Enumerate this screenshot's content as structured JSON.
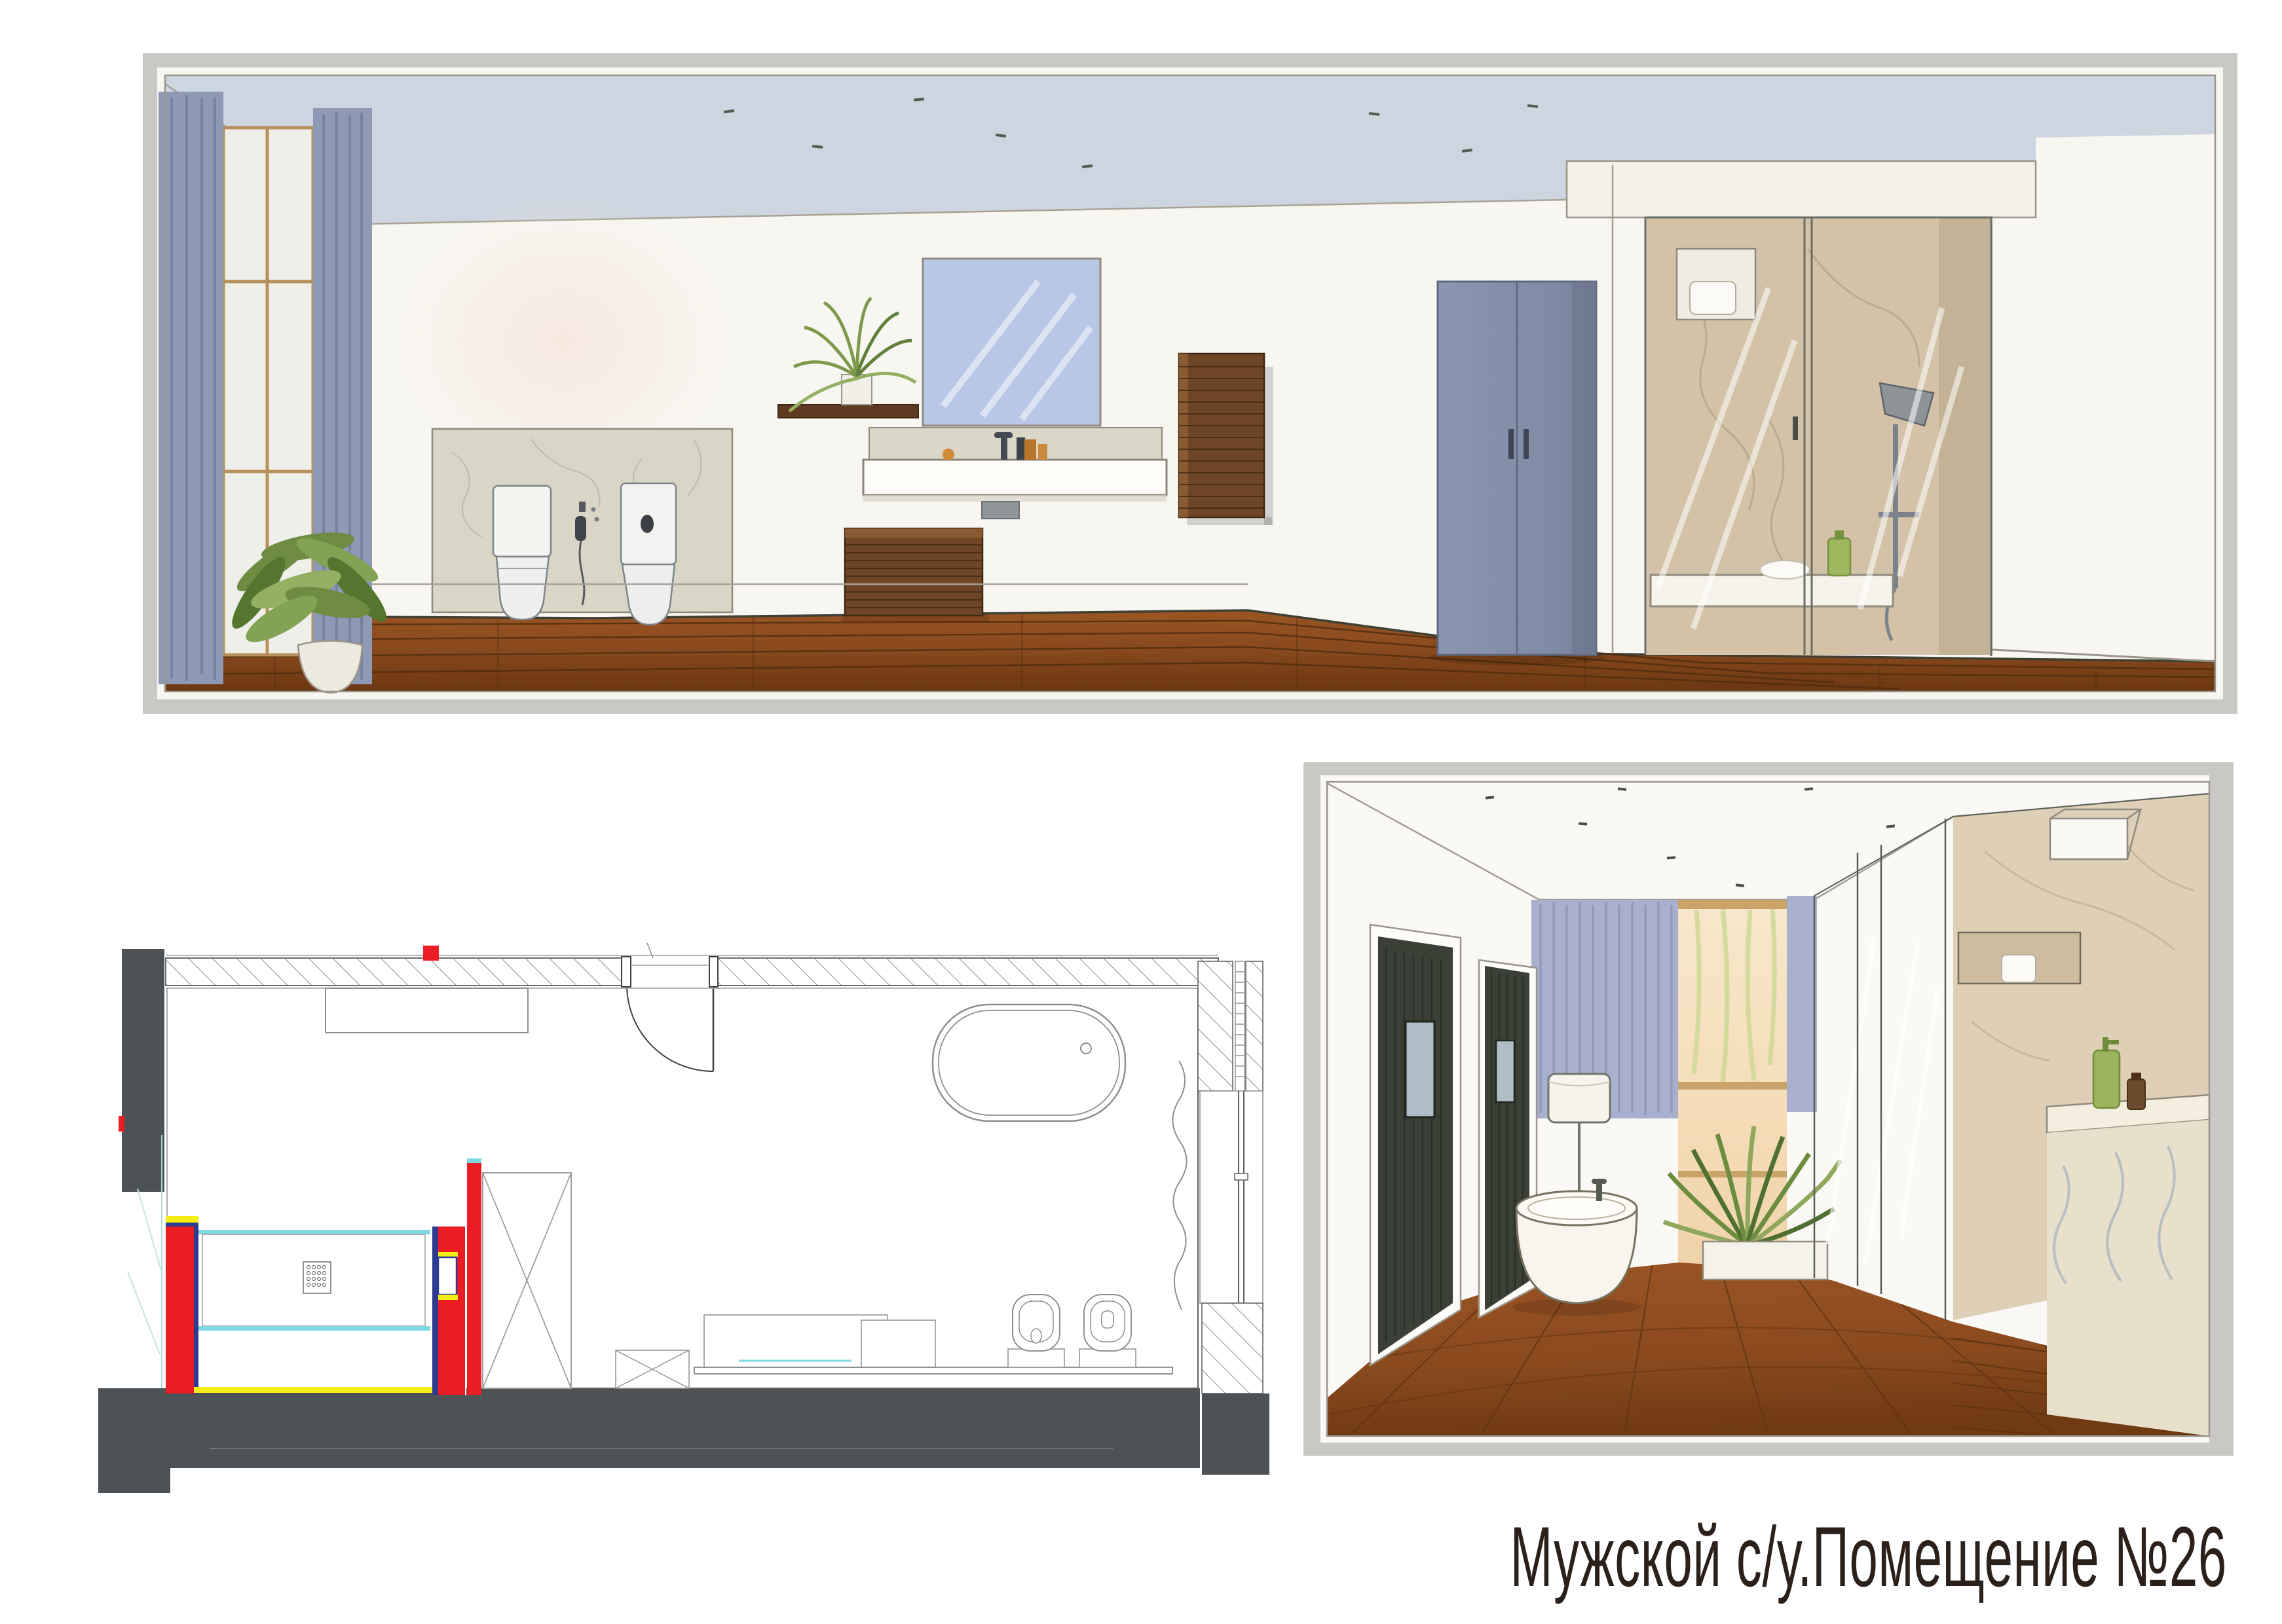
{
  "caption": {
    "text": "Мужской с/у.Помещение №26"
  },
  "palette": {
    "page_background": "#ffffff",
    "panel_frame_gray": "#cac8c5",
    "paper_cream": "#f8f6f1",
    "ceiling_wash_blue": "#cdd5e0",
    "wood_floor_brown": "#8a4a1e",
    "curtain_blue": "#8d99b5",
    "wardrobe_blue_gray": "#8792ac",
    "marble_beige": "#d3c2a8",
    "plant_green": "#7d9a4c",
    "dark_wood": "#6f4527",
    "plan_wall_dark_gray": "#4c5256",
    "plan_highlight_red": "#ec1c24",
    "plan_accent_blue": "#2c3a92",
    "plan_accent_yellow": "#f7ec13",
    "plan_glass_cyan": "#7fd8e2",
    "caption_ink": "#2b211a"
  }
}
